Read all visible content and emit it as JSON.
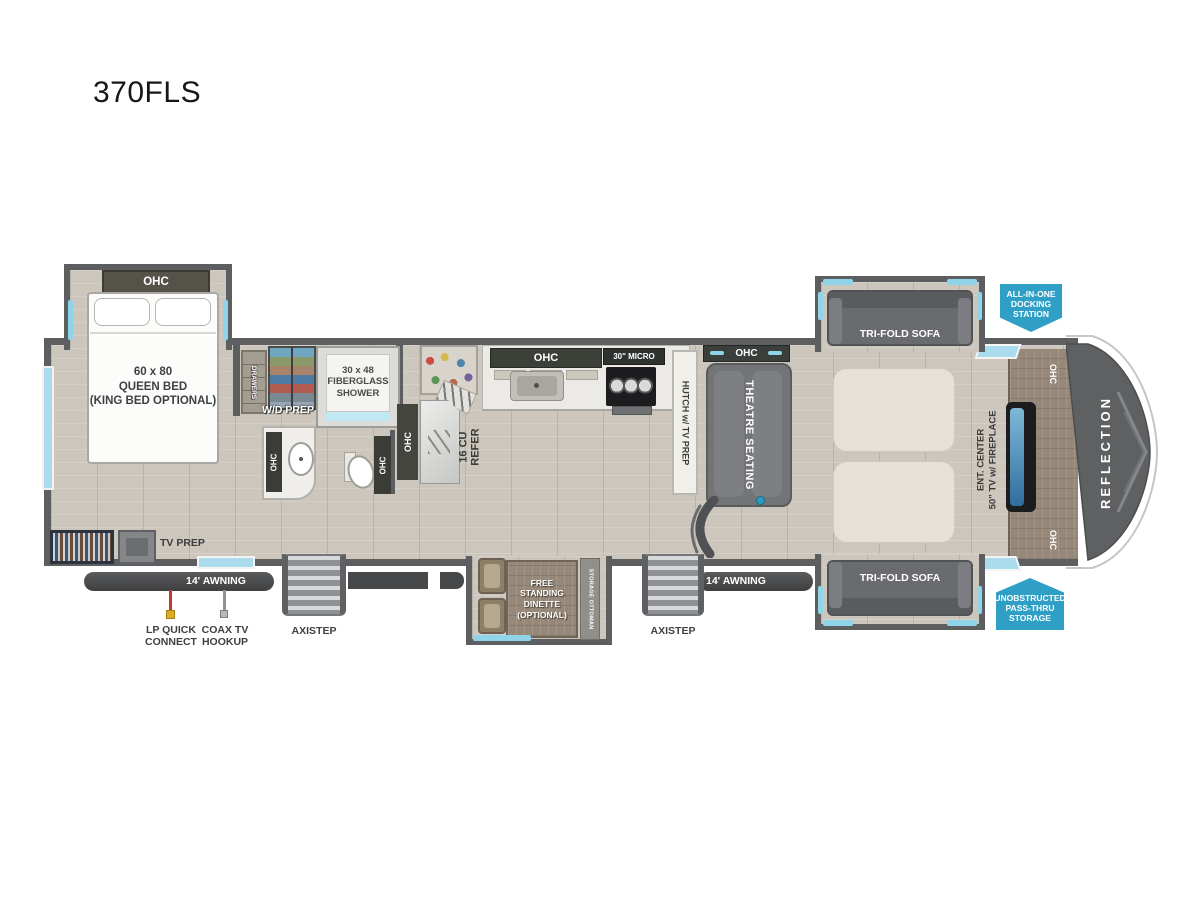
{
  "title": "370FLS",
  "colors": {
    "wall_gray": "#5d5e60",
    "accent_teal": "#8fd4e8",
    "badge_blue": "#2f9fc6",
    "wood_tone": "#97897a",
    "floor_tone": "#ccc6bd"
  },
  "bedroom": {
    "ohc": "OHC",
    "bed_label": "60 x 80\nQUEEN BED\n(KING BED OPTIONAL)",
    "tv_prep": "TV PREP"
  },
  "bath": {
    "drawers": "DRAWERS",
    "wd_prep": "W/D PREP",
    "shower": "30 x 48\nFIBERGLASS\nSHOWER",
    "vanity_ohc": "OHC",
    "toilet_ohc": "OHC"
  },
  "kitchen": {
    "ohc": "OHC",
    "micro": "30\" MICRO",
    "refer_ohc": "OHC",
    "refer": "16 CU\nREFER",
    "hutch": "HUTCH w/ TV PREP"
  },
  "living": {
    "theatre_ohc": "OHC",
    "theatre": "THEATRE SEATING",
    "sofa_top": "TRI-FOLD SOFA",
    "sofa_bottom": "TRI-FOLD SOFA",
    "ent_ohc_top": "OHC",
    "ent_ohc_bottom": "OHC",
    "ent_center": "ENT. CENTER\n50\" TV w/ FIREPLACE",
    "reflection": "REFLECTION"
  },
  "dinette": {
    "table": "FREE\nSTANDING\nDINETTE\n(OPTIONAL)",
    "ottoman": "STORAGE OTTOMAN"
  },
  "badges": {
    "docking": "ALL-IN-ONE\nDOCKING\nSTATION",
    "passthru": "UNOBSTRUCTED\nPASS-THRU\nSTORAGE"
  },
  "exterior": {
    "awning_left": "14' AWNING",
    "awning_right": "14' AWNING",
    "axistep_left": "AXISTEP",
    "axistep_right": "AXISTEP",
    "lp": "LP QUICK\nCONNECT",
    "coax": "COAX TV\nHOOKUP"
  }
}
